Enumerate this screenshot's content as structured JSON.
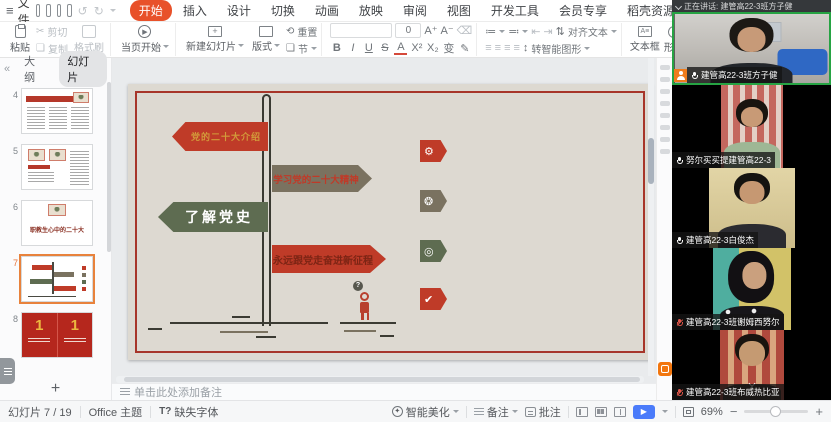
{
  "menu_bar": {
    "file_label": "文件",
    "tabs": [
      {
        "label": "开始",
        "active": true
      },
      {
        "label": "插入"
      },
      {
        "label": "设计"
      },
      {
        "label": "切换"
      },
      {
        "label": "动画"
      },
      {
        "label": "放映"
      },
      {
        "label": "审阅"
      },
      {
        "label": "视图"
      },
      {
        "label": "开发工具"
      },
      {
        "label": "会员专享"
      },
      {
        "label": "稻壳资源"
      }
    ],
    "search_placeholder": "查找命令、搜索模板"
  },
  "toolbar": {
    "paste_label": "粘贴",
    "cut_label": "剪切",
    "copy_label": "复制",
    "format_painter_label": "格式刷",
    "play_label": "当页开始",
    "new_slide_label": "新建幻灯片",
    "layout_label": "版式",
    "reset_label": "重置",
    "section_label": "节",
    "font_size_value": "0",
    "bold": "B",
    "italic": "I",
    "underline": "U",
    "strike": "S",
    "font_color": "A",
    "superscript": "X²",
    "subscript": "X₂",
    "change_case": "变",
    "grow_font": "A⁺",
    "shrink_font": "A⁻",
    "align_text_label": "对齐文本",
    "smart_graphic_label": "转智能图形",
    "textbox_label": "文本框",
    "shape_label": "形状",
    "picture_label": "图片",
    "arrange_label": "排列"
  },
  "sidebar": {
    "tab_outline": "大纲",
    "tab_slides": "幻灯片",
    "slides": [
      {
        "number": "4"
      },
      {
        "number": "5"
      },
      {
        "number": "6",
        "title": "职教生心中的二十大"
      },
      {
        "number": "7",
        "selected": true
      },
      {
        "number": "8",
        "left_number": "1",
        "right_number": "1"
      }
    ],
    "add_slide_label": "+"
  },
  "slide": {
    "signs": [
      {
        "text": "党的二十大介绍",
        "direction": "left",
        "bg": "#bf3b28",
        "fg": "#d29b3a"
      },
      {
        "text": "学习党的二十大精神",
        "direction": "right",
        "bg": "#7a7260",
        "fg": "#c03a28"
      },
      {
        "text": "了解党史",
        "direction": "left",
        "bg": "#5e6c51",
        "fg": "#ffffff"
      },
      {
        "text": "永远跟党走奋进新征程",
        "direction": "right",
        "bg": "#bf3b28",
        "fg": "#7c2414"
      }
    ],
    "badges": [
      {
        "icon": "gear-icon",
        "glyph": "⚙",
        "bg": "#bf3b28"
      },
      {
        "icon": "aperture-icon",
        "glyph": "❂",
        "bg": "#7a7260"
      },
      {
        "icon": "target-icon",
        "glyph": "◎",
        "bg": "#5e6c51"
      },
      {
        "icon": "check-icon",
        "glyph": "✔",
        "bg": "#bf3b28"
      }
    ],
    "question_mark": "?"
  },
  "notes_bar": {
    "placeholder": "单击此处添加备注"
  },
  "status_bar": {
    "slide_counter": "幻灯片 7 / 19",
    "theme_name": "Office 主题",
    "missing_font_icon": "T?",
    "missing_font_label": "缺失字体",
    "beautify_label": "智能美化",
    "notes_label": "备注",
    "comment_label": "批注",
    "zoom_percent": "69%",
    "zoom_minus": "−",
    "zoom_plus": "+"
  },
  "meeting_panel": {
    "speaking_banner": "正在讲话: 建管高22-3班方子健",
    "participants": [
      {
        "name": "建管高22-3班方子健",
        "mic": "on",
        "speaking": true
      },
      {
        "name": "努尔买买提建管高22-3",
        "mic": "on"
      },
      {
        "name": "建管高22-3白俊杰",
        "mic": "on"
      },
      {
        "name": "建管高22-3班谢姆西努尔",
        "mic": "muted"
      },
      {
        "name": "建管高22-3班布威热比亚",
        "mic": "muted"
      }
    ]
  },
  "colors": {
    "wps_accent_orange": "#e8512a",
    "selected_slide_border": "#e8823c",
    "speaking_green": "#26a343",
    "muted_red": "#e0564a",
    "play_button_blue": "#4a7bfa",
    "slide_bg": "#ddd9d1",
    "slide_frame_red": "#a73529"
  }
}
